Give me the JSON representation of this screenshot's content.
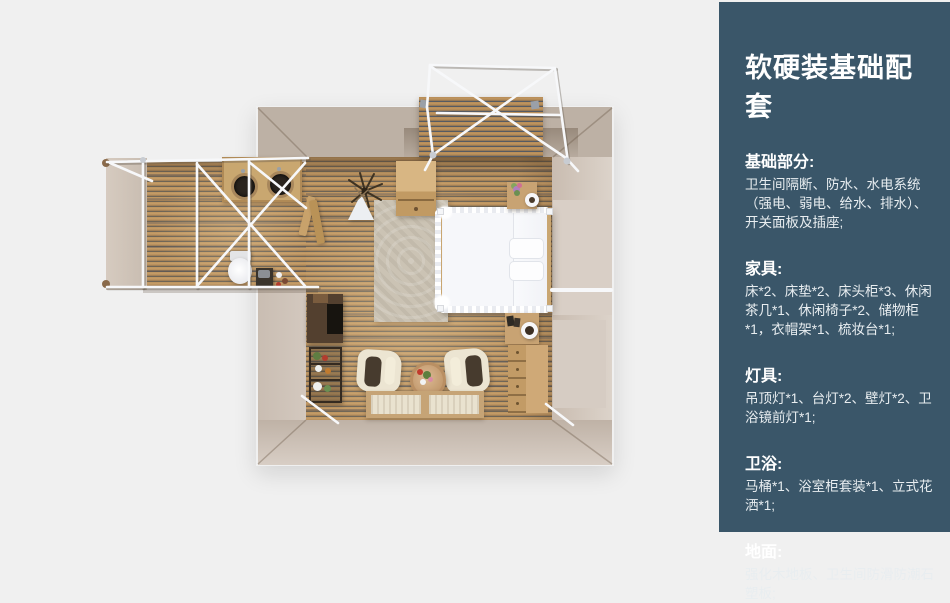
{
  "colors": {
    "page_background": "#f0f0f0",
    "sidebar_background": "#3a5669",
    "sidebar_text": "#ffffff",
    "wall_beige": "#cfc4ba",
    "wall_taupe": "#bdb1a5",
    "wood_floor": "#b68e5b",
    "tent_frame_white": "#f7f8fa",
    "furniture_oak": "#c8a373",
    "bed_white": "#f8f9fb"
  },
  "sidebar": {
    "title": "软硬装基础配套",
    "sections": [
      {
        "heading": "基础部分:",
        "body": "卫生间隔断、防水、水电系统（强电、弱电、给水、排水）、开关面板及插座;"
      },
      {
        "heading": "家具:",
        "body": "床*2、床垫*2、床头柜*3、休闲茶几*1、休闲椅子*2、储物柜*1，衣帽架*1、梳妆台*1;"
      },
      {
        "heading": "灯具:",
        "body": "吊顶灯*1、台灯*2、壁灯*2、卫浴镜前灯*1;"
      },
      {
        "heading": "卫浴:",
        "body": "马桶*1、浴室柜套装*1、立式花洒*1;"
      },
      {
        "heading": "地面:",
        "body": "强化木地板、卫生间防滑防潮石塑板;"
      }
    ]
  }
}
